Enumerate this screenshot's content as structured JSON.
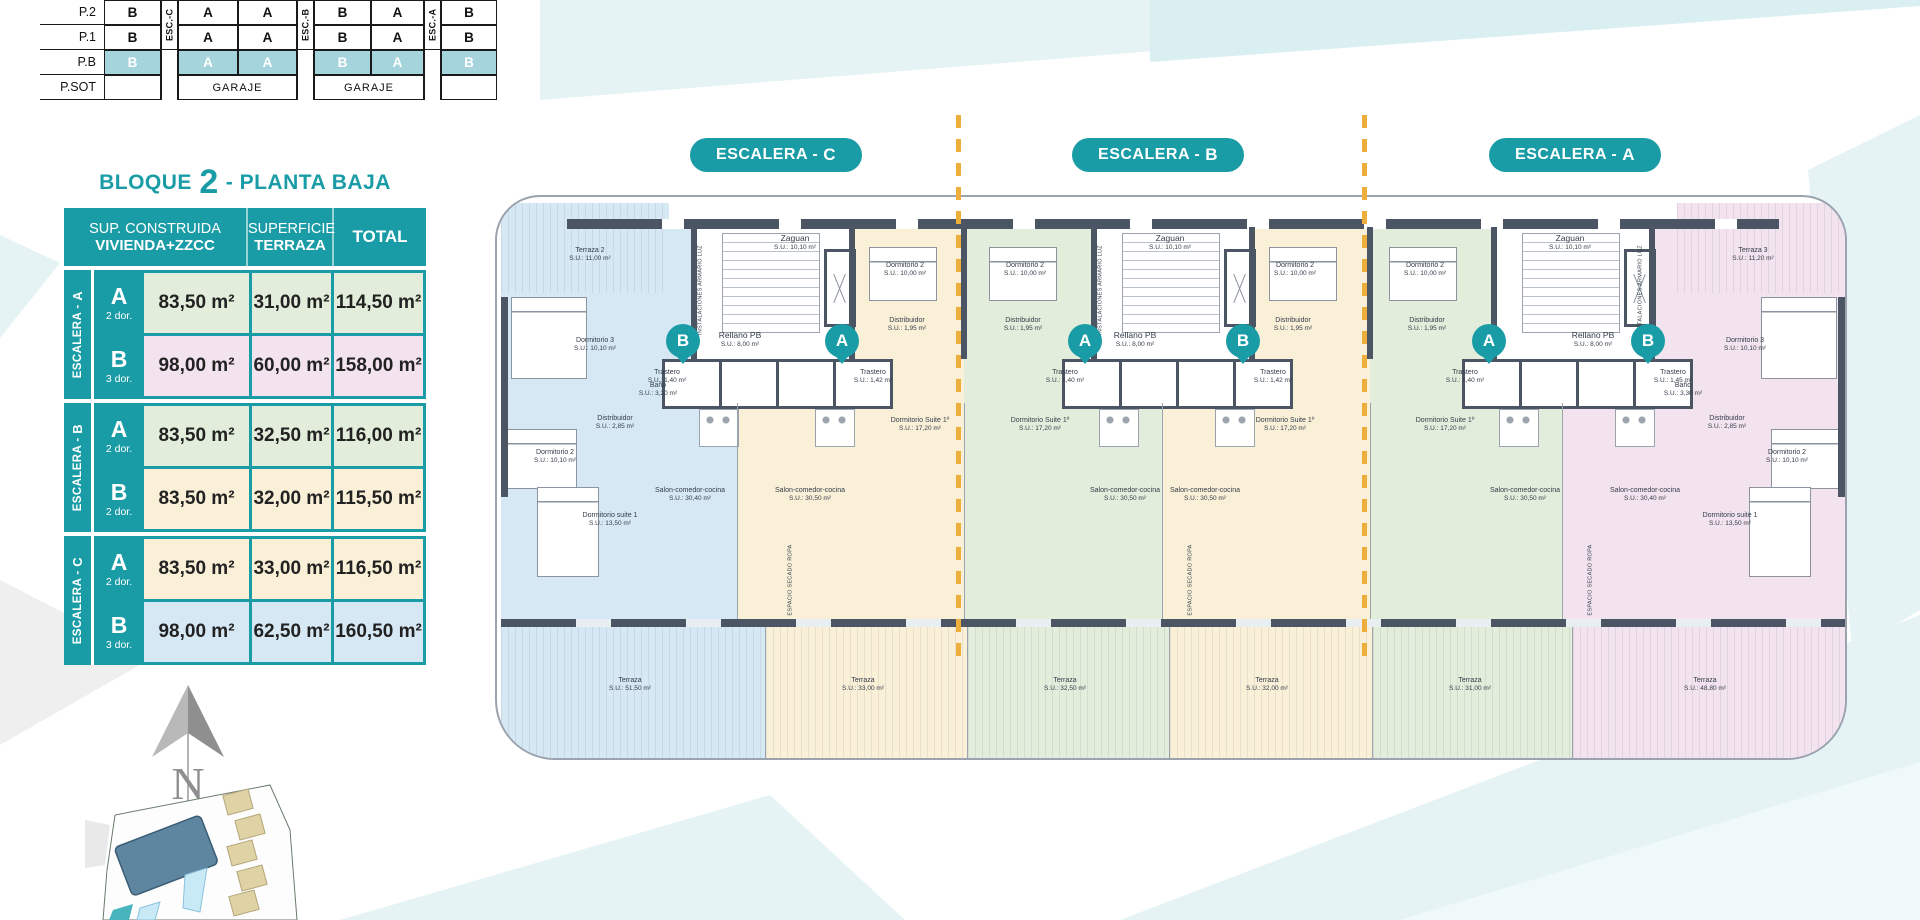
{
  "brand": {
    "teal": "#1A9CA7",
    "teal_light_highlight": "#A6D4DD",
    "wall_dark": "#4B5563",
    "dashed_line_orange": "#EDAE3C",
    "apartment_blue": "#D7E8F5",
    "apartment_cream": "#FAF0D8",
    "apartment_green": "#E3EDDB",
    "apartment_pink": "#F3E3EF"
  },
  "stack_table": {
    "row_labels": [
      "P.2",
      "P.1",
      "P.B",
      "P.SOT"
    ],
    "esc_labels": [
      "ESC.-C",
      "ESC.-B",
      "ESC.-A"
    ],
    "p2": [
      "B",
      "A",
      "A",
      "B",
      "A",
      "B"
    ],
    "p1": [
      "B",
      "A",
      "A",
      "B",
      "A",
      "B"
    ],
    "pb": [
      "B",
      "A",
      "A",
      "B",
      "A",
      "B"
    ],
    "garaje": "GARAJE"
  },
  "area_table": {
    "title": {
      "prefix": "BLOQUE",
      "number": "2",
      "suffix": "- PLANTA BAJA"
    },
    "header": {
      "col1_line1": "SUP. CONSTRUIDA",
      "col1_line2": "VIVIENDA+ZZCC",
      "col2_line1": "SUPERFICIE",
      "col2_line2": "TERRAZA",
      "col3": "TOTAL"
    },
    "groups": [
      {
        "label_prefix": "ESCALERA -",
        "label_letter": "A",
        "rows": [
          {
            "unit": "A",
            "dorms": "2 dor.",
            "built": "83,50 m²",
            "terrace": "31,00 m²",
            "total": "114,50 m²"
          },
          {
            "unit": "B",
            "dorms": "3 dor.",
            "built": "98,00 m²",
            "terrace": "60,00 m²",
            "total": "158,00 m²"
          }
        ]
      },
      {
        "label_prefix": "ESCALERA -",
        "label_letter": "B",
        "rows": [
          {
            "unit": "A",
            "dorms": "2 dor.",
            "built": "83,50 m²",
            "terrace": "32,50 m²",
            "total": "116,00 m²"
          },
          {
            "unit": "B",
            "dorms": "2 dor.",
            "built": "83,50 m²",
            "terrace": "32,00 m²",
            "total": "115,50 m²"
          }
        ]
      },
      {
        "label_prefix": "ESCALERA -",
        "label_letter": "C",
        "rows": [
          {
            "unit": "A",
            "dorms": "2 dor.",
            "built": "83,50 m²",
            "terrace": "33,00 m²",
            "total": "116,50 m²"
          },
          {
            "unit": "B",
            "dorms": "3 dor.",
            "built": "98,00 m²",
            "terrace": "62,50 m²",
            "total": "160,50 m²"
          }
        ]
      }
    ]
  },
  "pills": [
    {
      "prefix": "ESCALERA -",
      "letter": "C"
    },
    {
      "prefix": "ESCALERA -",
      "letter": "B"
    },
    {
      "prefix": "ESCALERA -",
      "letter": "A"
    }
  ],
  "compass": {
    "letter": "N"
  },
  "plan": {
    "badges": [
      {
        "x": 188,
        "y": 146,
        "l": "B"
      },
      {
        "x": 347,
        "y": 146,
        "l": "A"
      },
      {
        "x": 590,
        "y": 146,
        "l": "A"
      },
      {
        "x": 748,
        "y": 146,
        "l": "B"
      },
      {
        "x": 994,
        "y": 146,
        "l": "A"
      },
      {
        "x": 1153,
        "y": 146,
        "l": "B"
      }
    ],
    "labels": [
      {
        "x": 95,
        "y": 60,
        "n": "Terraza 2",
        "a": "S.U.: 11,00 m²"
      },
      {
        "x": 100,
        "y": 150,
        "n": "Dormitorio 3",
        "a": "S.U.: 10,10 m²"
      },
      {
        "x": 163,
        "y": 195,
        "n": "Baño",
        "a": "S.U.: 3,20 m²"
      },
      {
        "x": 120,
        "y": 228,
        "n": "Distribuidor",
        "a": "S.U.: 2,85 m²"
      },
      {
        "x": 60,
        "y": 262,
        "n": "Dormitorio 2",
        "a": "S.U.: 10,10 m²"
      },
      {
        "x": 115,
        "y": 325,
        "n": "Dormitorio suite 1",
        "a": "S.U.: 13,50 m²"
      },
      {
        "x": 195,
        "y": 300,
        "n": "Salon-comedor-cocina",
        "a": "S.U.: 30,40 m²"
      },
      {
        "x": 300,
        "y": 48,
        "n": "Zaguan",
        "a": "S.U.: 10,10 m²",
        "big": 1
      },
      {
        "x": 245,
        "y": 145,
        "n": "Rellano PB",
        "a": "S.U.: 8,00 m²",
        "big": 1
      },
      {
        "x": 206,
        "y": 95,
        "n": "INSTALACIONES ARMARIO LUZ",
        "v": 1
      },
      {
        "x": 172,
        "y": 182,
        "n": "Trastero",
        "a": "S.U.: 1,40 m²"
      },
      {
        "x": 378,
        "y": 182,
        "n": "Trastero",
        "a": "S.U.: 1,42 m²"
      },
      {
        "x": 410,
        "y": 75,
        "n": "Dormitorio 2",
        "a": "S.U.: 10,00 m²"
      },
      {
        "x": 412,
        "y": 130,
        "n": "Distribuidor",
        "a": "S.U.: 1,95 m²"
      },
      {
        "x": 425,
        "y": 230,
        "n": "Dormitorio Suite 1º",
        "a": "S.U.: 17,20 m²"
      },
      {
        "x": 315,
        "y": 300,
        "n": "Salon-comedor-cocina",
        "a": "S.U.: 30,50 m²"
      },
      {
        "x": 296,
        "y": 385,
        "n": "ESPACIO SECADO ROPA",
        "v": 1
      },
      {
        "x": 530,
        "y": 75,
        "n": "Dormitorio 2",
        "a": "S.U.: 10,00 m²"
      },
      {
        "x": 528,
        "y": 130,
        "n": "Distribuidor",
        "a": "S.U.: 1,95 m²"
      },
      {
        "x": 545,
        "y": 230,
        "n": "Dormitorio Suite 1º",
        "a": "S.U.: 17,20 m²"
      },
      {
        "x": 630,
        "y": 300,
        "n": "Salon-comedor-cocina",
        "a": "S.U.: 30,50 m²"
      },
      {
        "x": 570,
        "y": 182,
        "n": "Trastero",
        "a": "S.U.: 1,40 m²"
      },
      {
        "x": 675,
        "y": 48,
        "n": "Zaguan",
        "a": "S.U.: 10,10 m²",
        "big": 1
      },
      {
        "x": 640,
        "y": 145,
        "n": "Rellano PB",
        "a": "S.U.: 8,00 m²",
        "big": 1
      },
      {
        "x": 606,
        "y": 95,
        "n": "INSTALACIONES ARMARIO LUZ",
        "v": 1
      },
      {
        "x": 778,
        "y": 182,
        "n": "Trastero",
        "a": "S.U.: 1,42 m²"
      },
      {
        "x": 800,
        "y": 75,
        "n": "Dormitorio 2",
        "a": "S.U.: 10,00 m²"
      },
      {
        "x": 798,
        "y": 130,
        "n": "Distribuidor",
        "a": "S.U.: 1,95 m²"
      },
      {
        "x": 790,
        "y": 230,
        "n": "Dormitorio Suite 1º",
        "a": "S.U.: 17,20 m²"
      },
      {
        "x": 710,
        "y": 300,
        "n": "Salon-comedor-cocina",
        "a": "S.U.: 30,50 m²"
      },
      {
        "x": 696,
        "y": 385,
        "n": "ESPACIO SECADO ROPA",
        "v": 1
      },
      {
        "x": 930,
        "y": 75,
        "n": "Dormitorio 2",
        "a": "S.U.: 10,00 m²"
      },
      {
        "x": 932,
        "y": 130,
        "n": "Distribuidor",
        "a": "S.U.: 1,95 m²"
      },
      {
        "x": 950,
        "y": 230,
        "n": "Dormitorio Suite 1º",
        "a": "S.U.: 17,20 m²"
      },
      {
        "x": 1030,
        "y": 300,
        "n": "Salon-comedor-cocina",
        "a": "S.U.: 30,50 m²"
      },
      {
        "x": 970,
        "y": 182,
        "n": "Trastero",
        "a": "S.U.: 1,40 m²"
      },
      {
        "x": 1075,
        "y": 48,
        "n": "Zaguan",
        "a": "S.U.: 10,10 m²",
        "big": 1
      },
      {
        "x": 1098,
        "y": 145,
        "n": "Rellano PB",
        "a": "S.U.: 8,00 m²",
        "big": 1
      },
      {
        "x": 1146,
        "y": 95,
        "n": "INSTALACIONES ARMARIO LUZ",
        "v": 1
      },
      {
        "x": 1178,
        "y": 182,
        "n": "Trastero",
        "a": "S.U.: 1,45 m²"
      },
      {
        "x": 1096,
        "y": 385,
        "n": "ESPACIO SECADO ROPA",
        "v": 1
      },
      {
        "x": 1258,
        "y": 60,
        "n": "Terraza 3",
        "a": "S.U.: 11,20 m²"
      },
      {
        "x": 1250,
        "y": 150,
        "n": "Dormitorio 3",
        "a": "S.U.: 10,10 m²"
      },
      {
        "x": 1188,
        "y": 195,
        "n": "Baño",
        "a": "S.U.: 3,30 m²"
      },
      {
        "x": 1232,
        "y": 228,
        "n": "Distribuidor",
        "a": "S.U.: 2,85 m²"
      },
      {
        "x": 1292,
        "y": 262,
        "n": "Dormitorio 2",
        "a": "S.U.: 10,10 m²"
      },
      {
        "x": 1235,
        "y": 325,
        "n": "Dormitorio suite 1",
        "a": "S.U.: 13,50 m²"
      },
      {
        "x": 1150,
        "y": 300,
        "n": "Salon-comedor-cocina",
        "a": "S.U.: 30,40 m²"
      },
      {
        "x": 135,
        "y": 490,
        "n": "Terraza",
        "a": "S.U.: 51,50 m²"
      },
      {
        "x": 368,
        "y": 490,
        "n": "Terraza",
        "a": "S.U.: 33,00 m²"
      },
      {
        "x": 570,
        "y": 490,
        "n": "Terraza",
        "a": "S.U.: 32,50 m²"
      },
      {
        "x": 772,
        "y": 490,
        "n": "Terraza",
        "a": "S.U.: 32,00 m²"
      },
      {
        "x": 975,
        "y": 490,
        "n": "Terraza",
        "a": "S.U.: 31,00 m²"
      },
      {
        "x": 1210,
        "y": 490,
        "n": "Terraza",
        "a": "S.U.: 48,80 m²"
      }
    ]
  }
}
